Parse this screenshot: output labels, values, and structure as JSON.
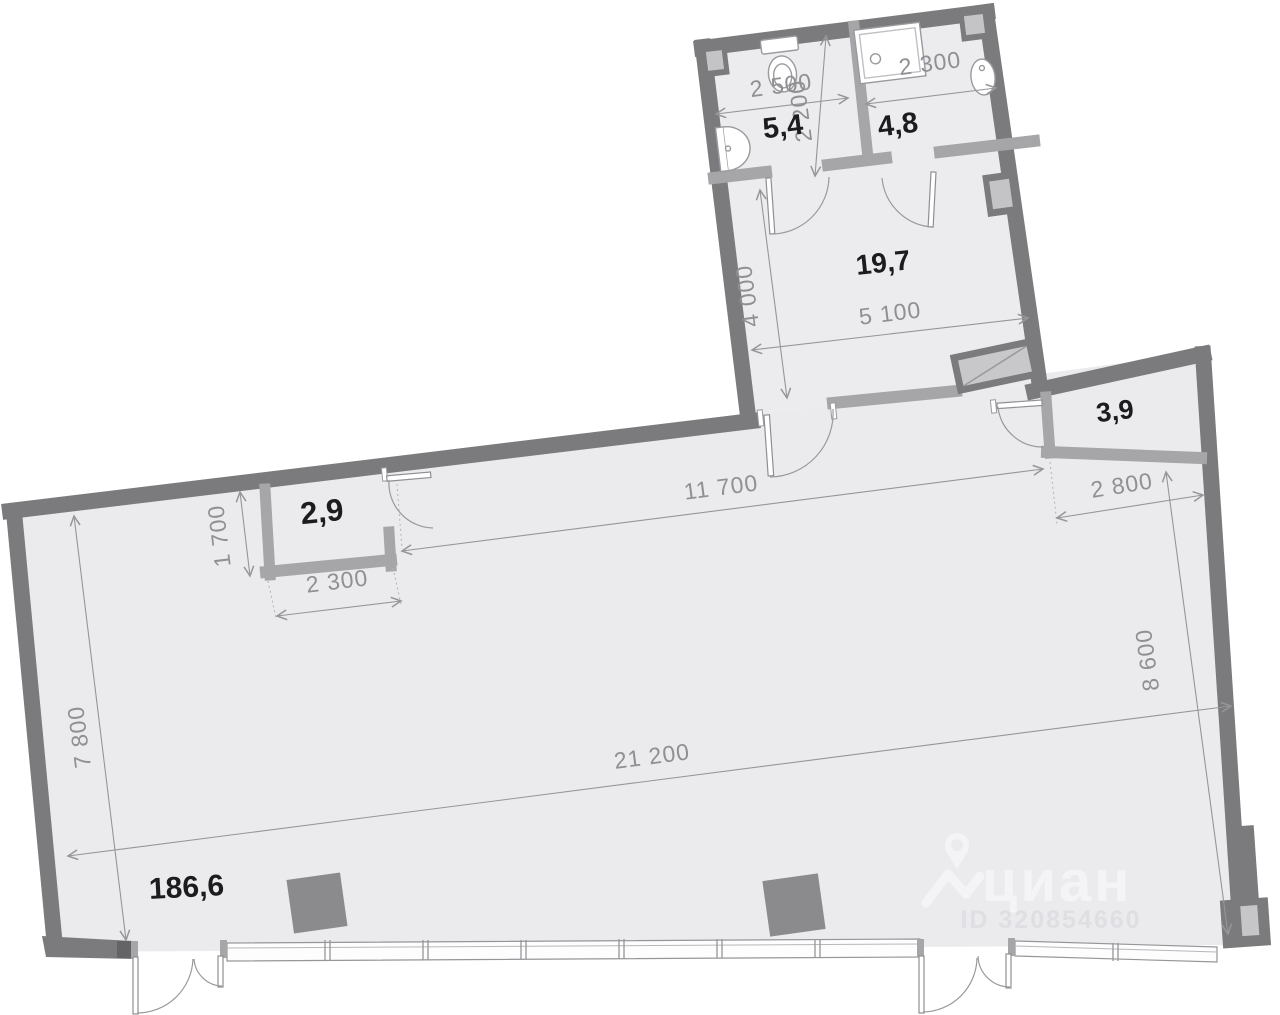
{
  "plan": {
    "rooms": [
      {
        "name": "bathroom-left",
        "area": "5,4"
      },
      {
        "name": "bathroom-right",
        "area": "4,8"
      },
      {
        "name": "hall",
        "area": "19,7"
      },
      {
        "name": "storage-right",
        "area": "3,9"
      },
      {
        "name": "storage-left",
        "area": "2,9"
      },
      {
        "name": "main-hall",
        "area": "186,6"
      }
    ],
    "dims": {
      "bath1_width": "2 500",
      "bath1_depth": "2 200",
      "bath2_width": "2 300",
      "hall_depth": "4 000",
      "hall_width": "5 100",
      "top_span": "11 700",
      "right_room_width": "2 800",
      "left_room_depth": "1 700",
      "left_room_width": "2 300",
      "left_wall": "7 800",
      "bottom_span": "21 200",
      "right_wall": "8 600"
    },
    "watermark": {
      "brand": "циан",
      "id": "ID 320854660"
    },
    "colors": {
      "wall": "#7b7b7d",
      "partition": "#a6a6a8",
      "floor": "#ebebed",
      "dimension": "#96969a",
      "label": "#1c1c1e"
    }
  }
}
